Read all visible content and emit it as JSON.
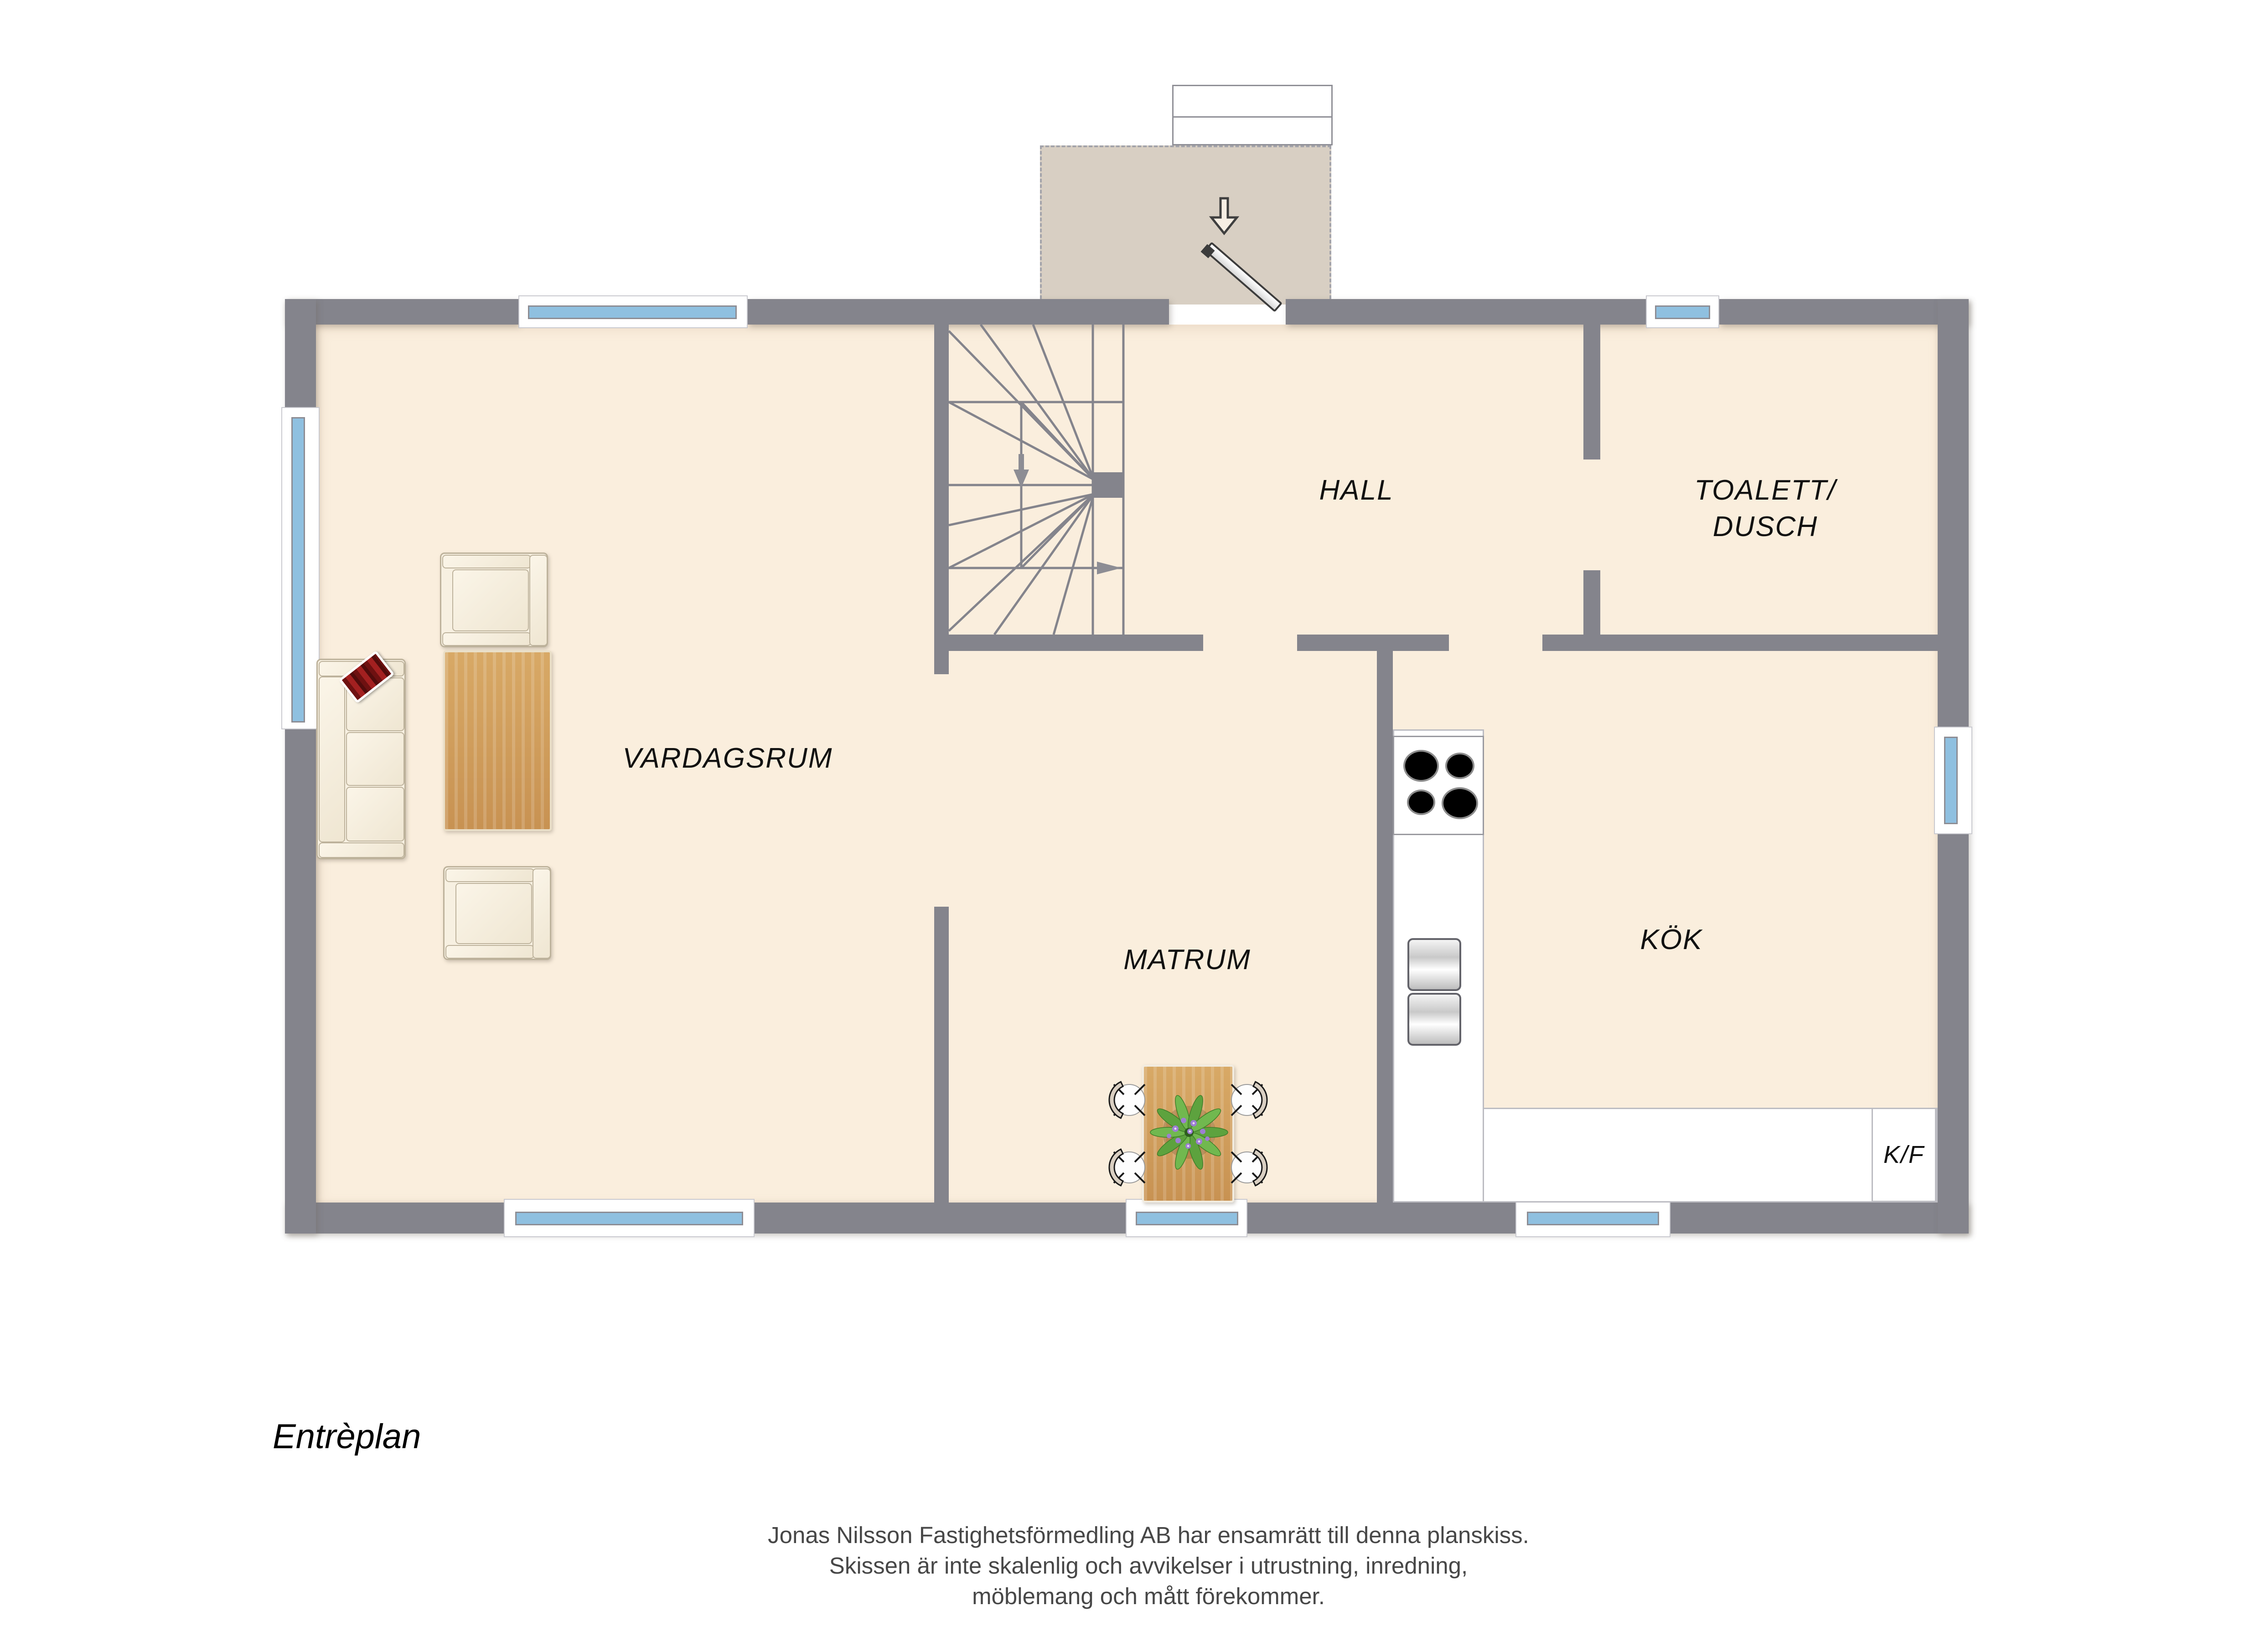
{
  "floorplan": {
    "level_label": "Entrèplan",
    "rooms": [
      {
        "id": "vardagsrum",
        "label": "VARDAGSRUM"
      },
      {
        "id": "hall",
        "label": "HALL"
      },
      {
        "id": "toalett_dusch",
        "label_line1": "TOALETT/",
        "label_line2": "DUSCH"
      },
      {
        "id": "matrum",
        "label": "MATRUM"
      },
      {
        "id": "kok",
        "label": "KÖK"
      }
    ],
    "kitchen": {
      "fridge_freezer_label": "K/F"
    },
    "disclaimer": {
      "line1": "Jonas Nilsson Fastighetsförmedling AB har ensamrätt till denna planskiss.",
      "line2": "Skissen är inte skalenlig och avvikelser i utrustning, inredning,",
      "line3": "möblemang och mått förekommer."
    },
    "icons": [
      {
        "name": "entry-direction-arrow",
        "meaning": "entrance direction into hall"
      },
      {
        "name": "stairs-down-arrow",
        "meaning": "stair direction down"
      },
      {
        "name": "stairs-exit-arrow",
        "meaning": "stair exit direction"
      }
    ],
    "colors": {
      "wall": "#84848c",
      "floor": "#faeedd",
      "porch": "#d8cfc3",
      "glass": "#8fc0e0",
      "ink": "#111111",
      "wood1": "#d8a966",
      "wood2": "#c89252",
      "pillow": "#a32020",
      "uph": "#f7f0e1",
      "uph_line": "#bdb29b",
      "plant": "#5da23e"
    }
  }
}
